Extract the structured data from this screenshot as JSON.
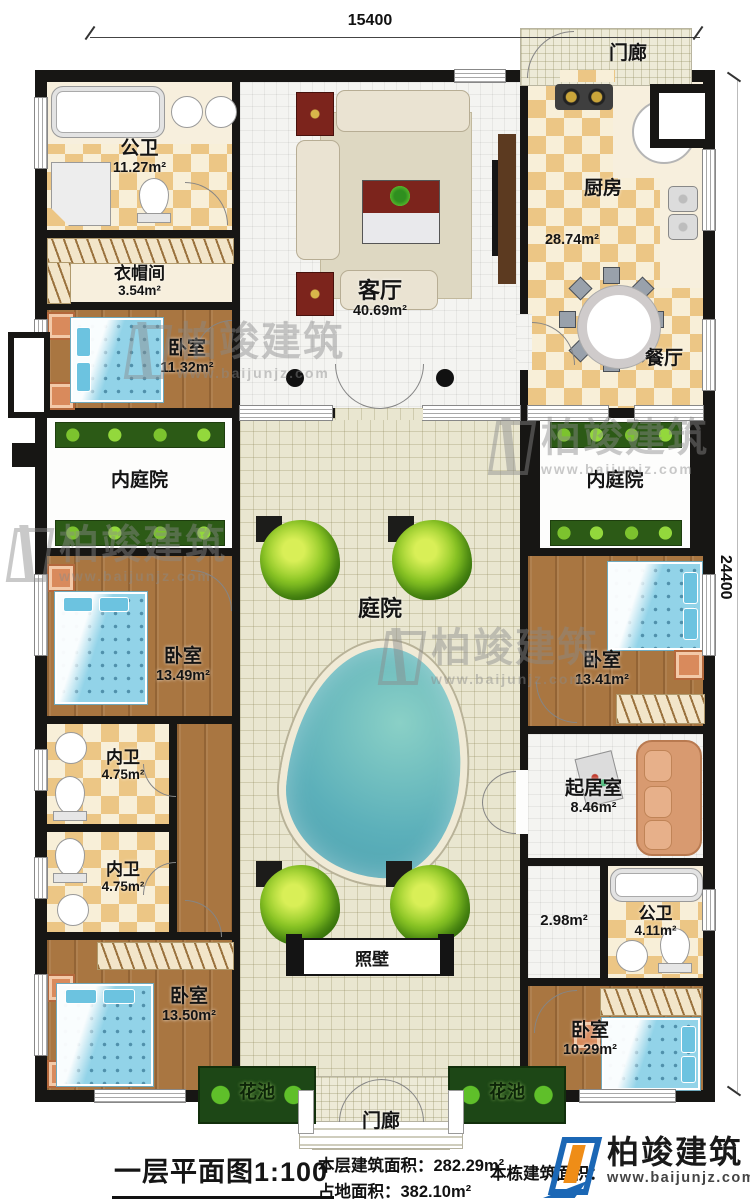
{
  "dimensions": {
    "width_label": "15400",
    "height_label": "24400"
  },
  "watermark": {
    "brand": "柏竣建筑",
    "url": "www.baijunjz.com"
  },
  "rooms": {
    "gongwei1": {
      "label": "公卫",
      "area": "11.27m²"
    },
    "yimaojian": {
      "label": "衣帽间",
      "area": "3.54m²"
    },
    "woshi_a": {
      "label": "卧室",
      "area": "11.32m²"
    },
    "keting": {
      "label": "客厅",
      "area": "40.69m²"
    },
    "chufang": {
      "label": "厨房",
      "area": "28.74m²"
    },
    "canting": {
      "label": "餐厅"
    },
    "neiting_l": {
      "label": "内庭院"
    },
    "neiting_r": {
      "label": "内庭院"
    },
    "tingyuan": {
      "label": "庭院"
    },
    "woshi_b": {
      "label": "卧室",
      "area": "13.49m²"
    },
    "neiwei_1": {
      "label": "内卫",
      "area": "4.75m²"
    },
    "neiwei_2": {
      "label": "内卫",
      "area": "4.75m²"
    },
    "woshi_c": {
      "label": "卧室",
      "area": "13.50m²"
    },
    "woshi_d": {
      "label": "卧室",
      "area": "13.41m²"
    },
    "qijushi": {
      "label": "起居室",
      "area": "8.46m²"
    },
    "hall": {
      "area": "2.98m²"
    },
    "gongwei2": {
      "label": "公卫",
      "area": "4.11m²"
    },
    "woshi_e": {
      "label": "卧室",
      "area": "10.29m²"
    },
    "zhaobi": {
      "label": "照壁"
    },
    "huachi_l": {
      "label": "花池"
    },
    "huachi_r": {
      "label": "花池"
    },
    "menlang_t": {
      "label": "门廊"
    },
    "menlang_b": {
      "label": "门廊"
    }
  },
  "footer": {
    "plan_title": "一层平面图",
    "scale": "1:100",
    "floor_area_label": "本层建筑面积：",
    "floor_area_value": "282.29m²",
    "land_area_label": "占地面积：",
    "land_area_value": "382.10m²",
    "building_area_label": "本栋建筑面积：",
    "logo_brand": "柏竣建筑",
    "logo_url": "www.baijunjz.com"
  },
  "colors": {
    "wall": "#171614",
    "checker_tan": "#ecc685",
    "cream": "#f7efdd",
    "wood": "#a97641",
    "tile_white": "#f4f4f1",
    "tile_court": "#e9e6d0",
    "hedge_green": "#2c5a16",
    "tree_green": "#8cc725",
    "pond_teal": "#5cb0ba",
    "bed_blue": "#92d3e8",
    "logo_blue": "#1b67b5",
    "logo_orange": "#ef8d17"
  }
}
